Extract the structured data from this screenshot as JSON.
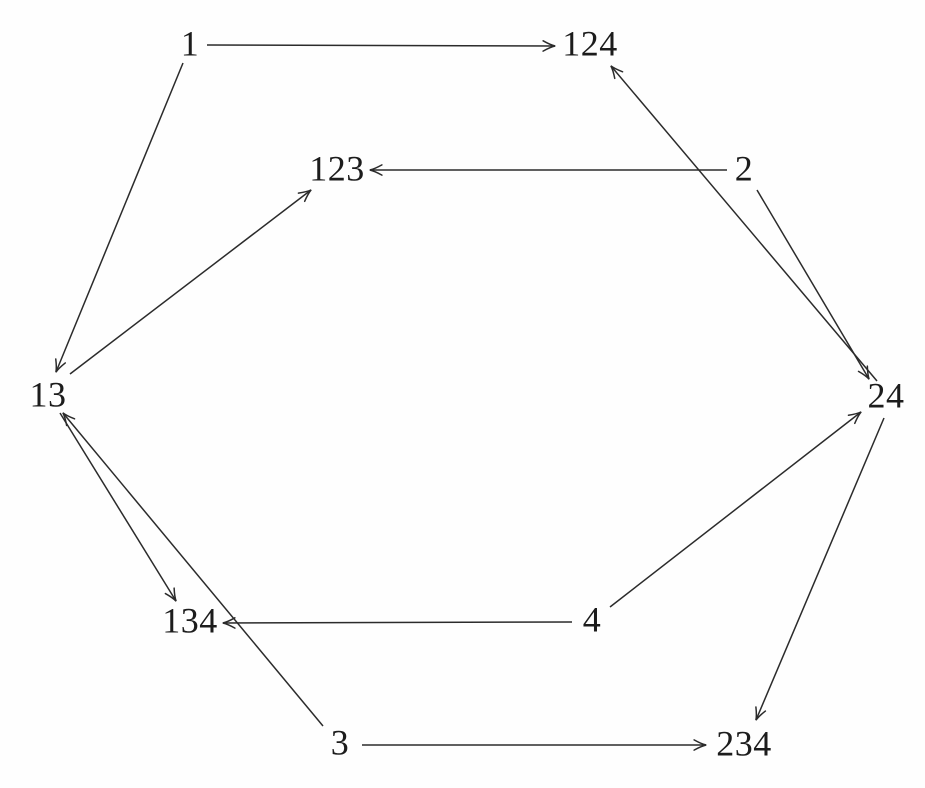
{
  "figure": {
    "title": "directed-graph-of-labeled-sets",
    "background_color": "#fefefe",
    "line_color": "#2b2b2b",
    "text_color": "#1c1c1c"
  },
  "graph": {
    "nodes": [
      {
        "id": "1",
        "label": "1",
        "x": 190,
        "y": 45
      },
      {
        "id": "124",
        "label": "124",
        "x": 590,
        "y": 45
      },
      {
        "id": "123",
        "label": "123",
        "x": 337,
        "y": 170
      },
      {
        "id": "2",
        "label": "2",
        "x": 744,
        "y": 170
      },
      {
        "id": "13",
        "label": "13",
        "x": 48,
        "y": 396
      },
      {
        "id": "24",
        "label": "24",
        "x": 886,
        "y": 397
      },
      {
        "id": "134",
        "label": "134",
        "x": 190,
        "y": 622
      },
      {
        "id": "4",
        "label": "4",
        "x": 592,
        "y": 621
      },
      {
        "id": "3",
        "label": "3",
        "x": 340,
        "y": 744
      },
      {
        "id": "234",
        "label": "234",
        "x": 744,
        "y": 745
      }
    ],
    "edges": [
      {
        "from": "1",
        "to": "124",
        "x1": 207,
        "y1": 45,
        "x2": 555,
        "y2": 46
      },
      {
        "from": "1",
        "to": "13",
        "x1": 183,
        "y1": 63,
        "x2": 56,
        "y2": 372
      },
      {
        "from": "2",
        "to": "123",
        "x1": 727,
        "y1": 170,
        "x2": 370,
        "y2": 170
      },
      {
        "from": "2",
        "to": "24",
        "x1": 757,
        "y1": 190,
        "x2": 869,
        "y2": 379
      },
      {
        "from": "13",
        "to": "123",
        "x1": 70,
        "y1": 374,
        "x2": 311,
        "y2": 190
      },
      {
        "from": "13",
        "to": "134",
        "x1": 60,
        "y1": 413,
        "x2": 176,
        "y2": 601
      },
      {
        "from": "24",
        "to": "124",
        "x1": 877,
        "y1": 381,
        "x2": 611,
        "y2": 66
      },
      {
        "from": "24",
        "to": "234",
        "x1": 884,
        "y1": 418,
        "x2": 756,
        "y2": 720
      },
      {
        "from": "3",
        "to": "13",
        "x1": 323,
        "y1": 726,
        "x2": 63,
        "y2": 413
      },
      {
        "from": "3",
        "to": "234",
        "x1": 362,
        "y1": 745,
        "x2": 706,
        "y2": 745
      },
      {
        "from": "4",
        "to": "134",
        "x1": 572,
        "y1": 622,
        "x2": 223,
        "y2": 623
      },
      {
        "from": "4",
        "to": "24",
        "x1": 610,
        "y1": 607,
        "x2": 861,
        "y2": 412
      }
    ]
  }
}
